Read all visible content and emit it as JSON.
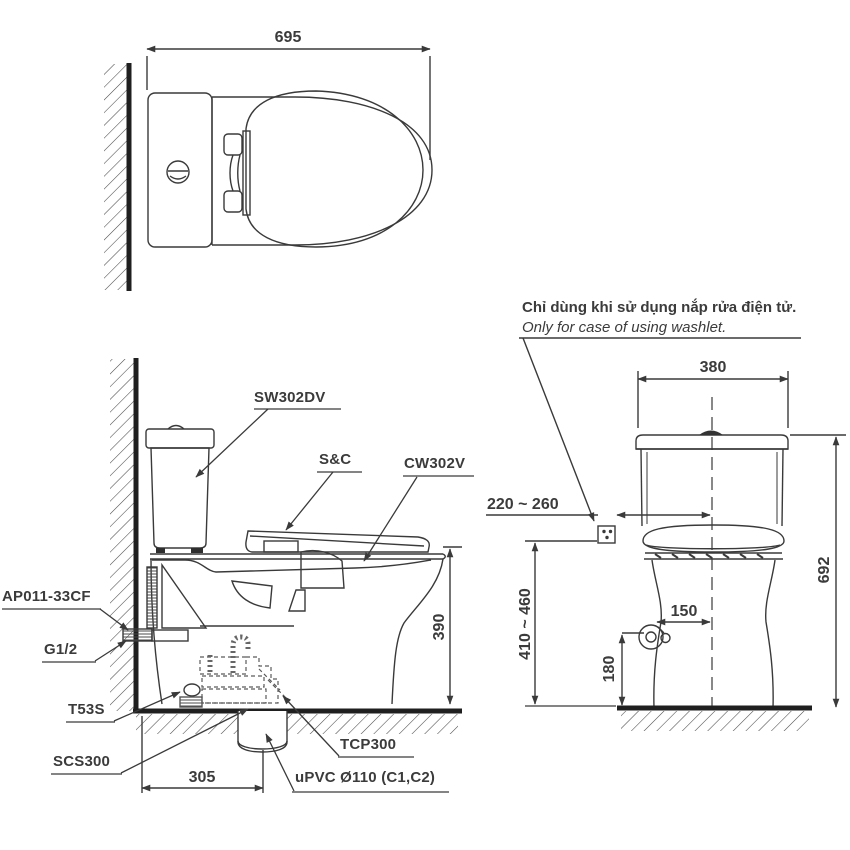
{
  "drawing": {
    "kind": "two-piece toilet installation technical drawing",
    "colors": {
      "line": "#3a3a3a",
      "heavy_line": "#1f1f1f",
      "background": "#ffffff",
      "text": "#3b3b3b"
    },
    "top_view": {
      "width_dim": "695"
    },
    "side_view": {
      "tank_model": "SW302DV",
      "seat_model": "S&C",
      "bowl_model": "CW302V",
      "stop_valve": "AP011-33CF",
      "supply_thread": "G1/2",
      "seal": "T53S",
      "connector": "SCS300",
      "flange": "TCP300",
      "drain_pipe": "uPVC Ø110 (C1,C2)",
      "rim_height_dim": "390",
      "drain_offset_dim": "305"
    },
    "front_view": {
      "note_vi": "Chỉ dùng khi sử dụng nắp rửa điện tử.",
      "note_en": "Only for case of using washlet.",
      "tank_width_dim": "380",
      "total_height_dim": "692",
      "outlet_offset_dim": "220 ~ 260",
      "outlet_height_dim": "410 ~ 460",
      "valve_offset_dim": "150",
      "valve_height_dim": "180"
    }
  }
}
